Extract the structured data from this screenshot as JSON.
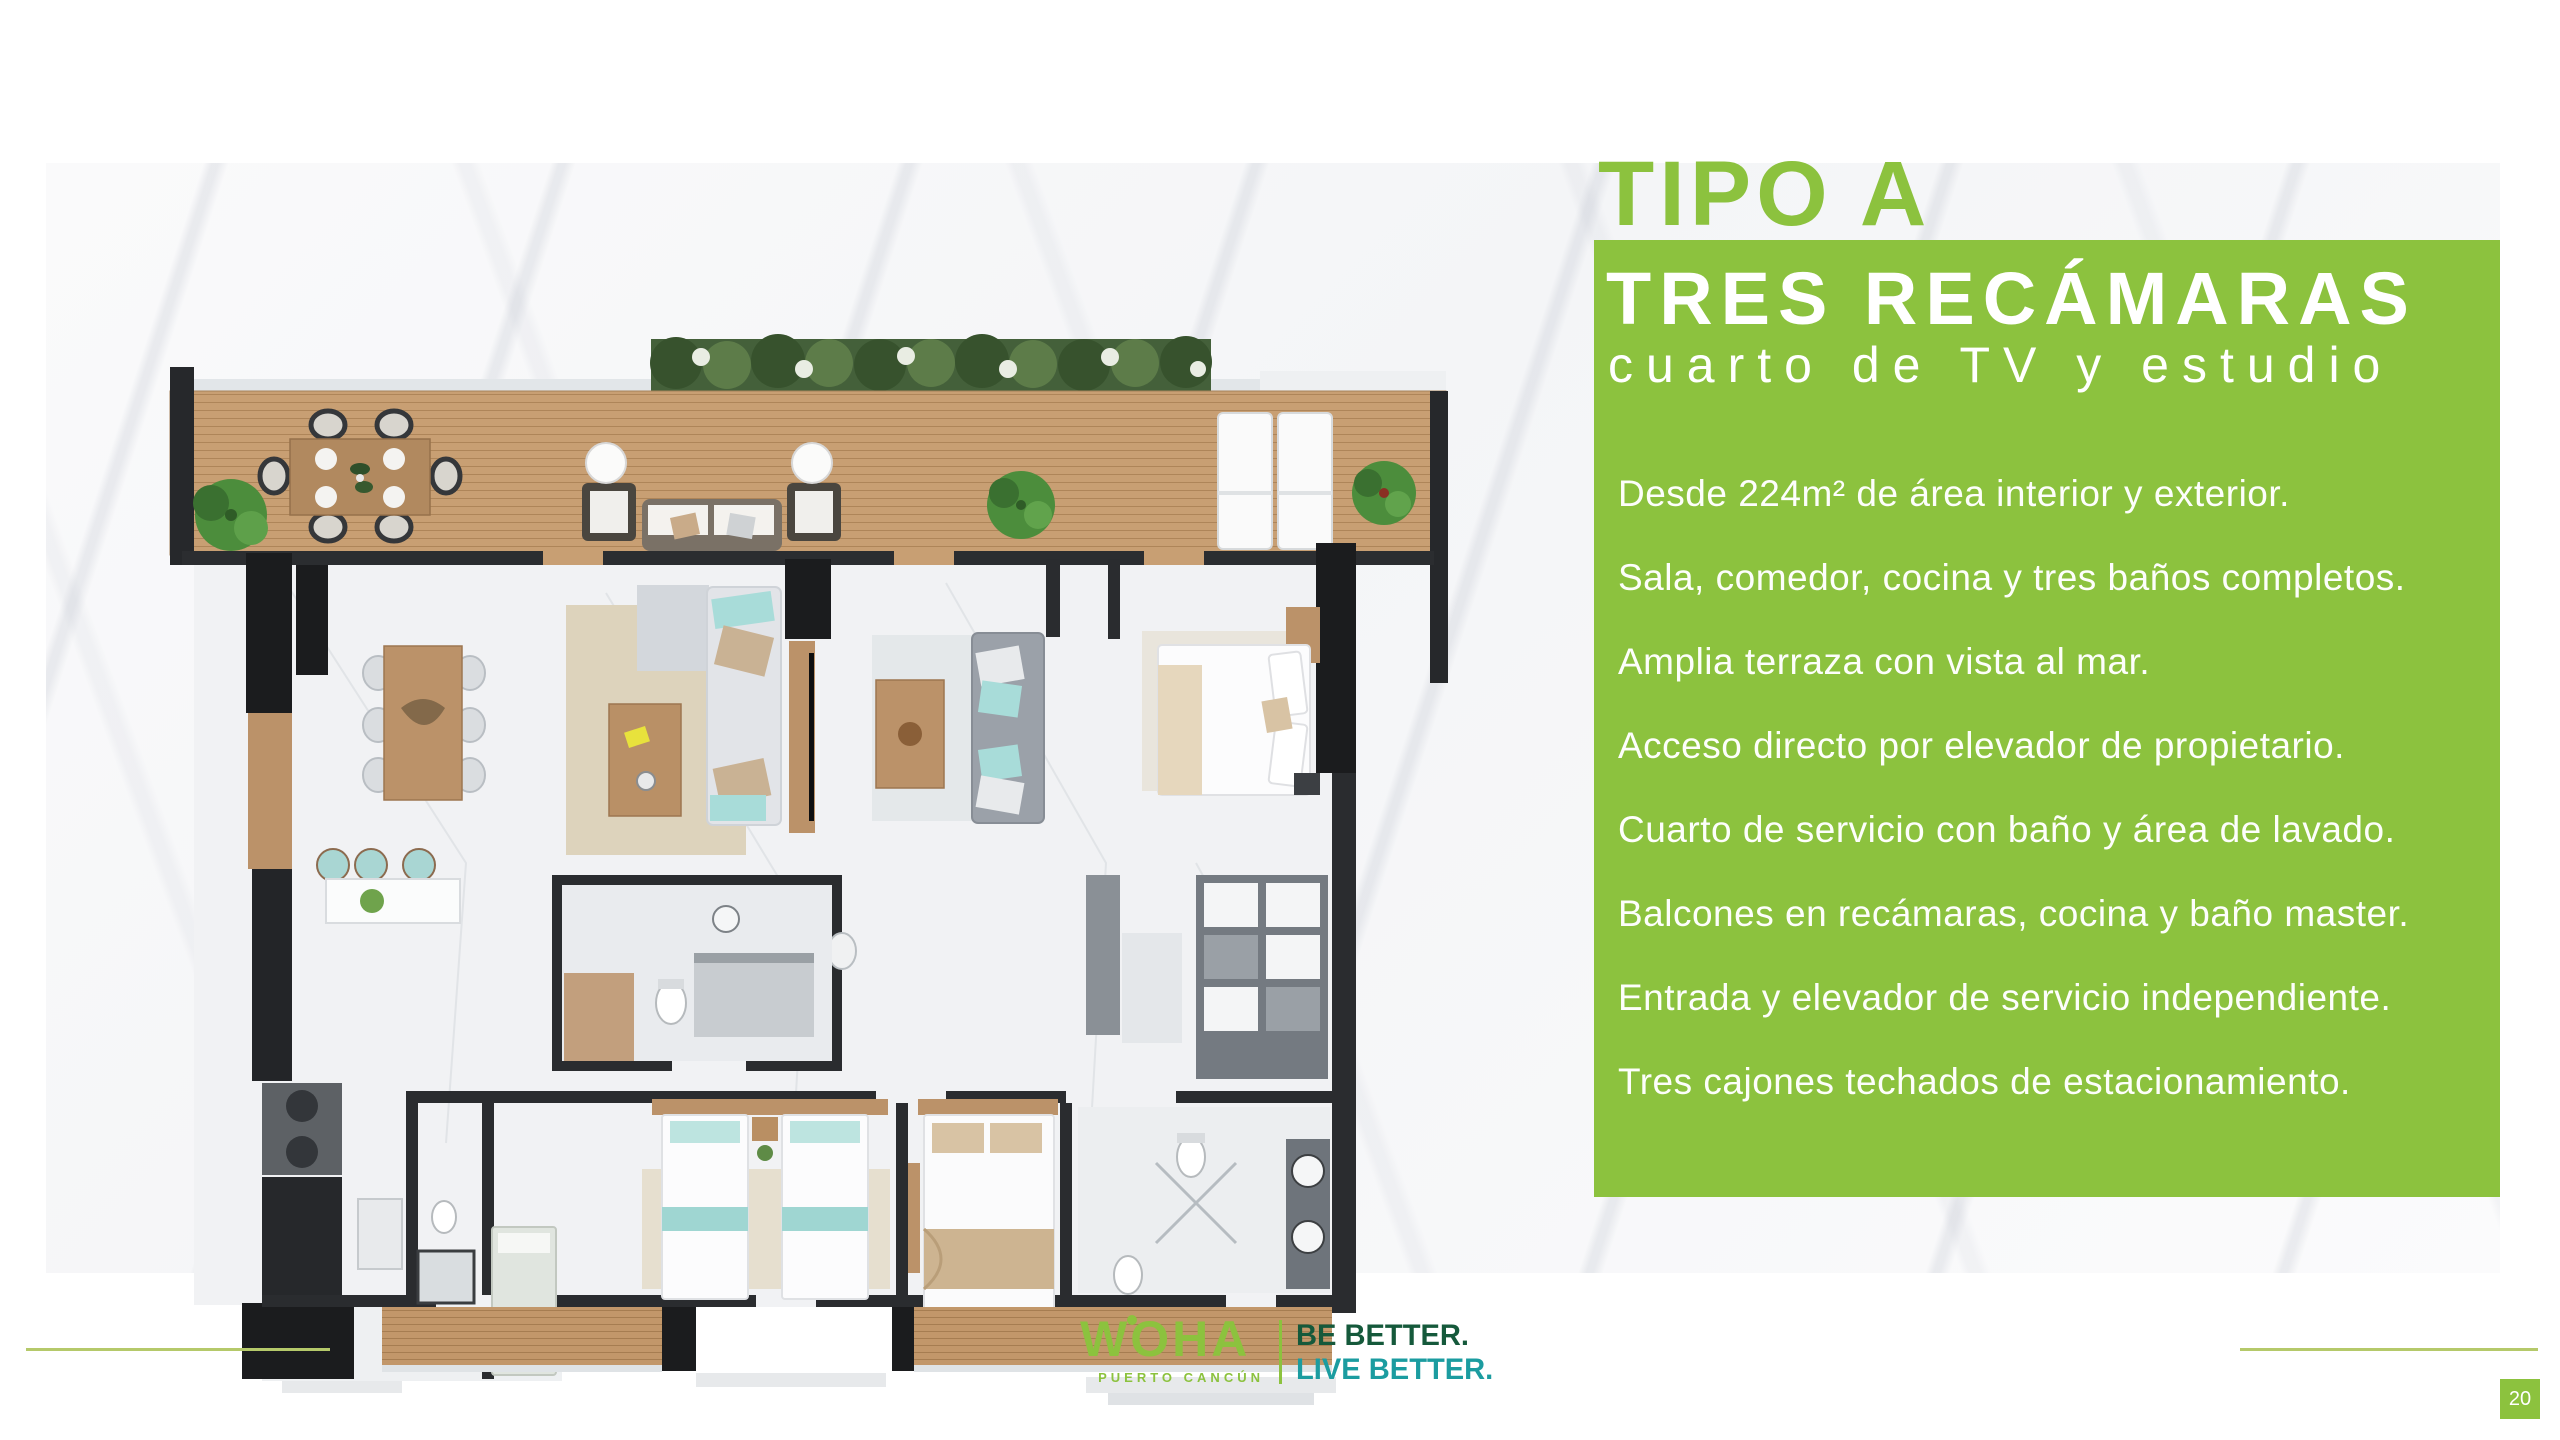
{
  "panel": {
    "eyebrow": "TIPO A",
    "title": "TRES RECÁMARAS",
    "subtitle": "cuarto de TV y estudio",
    "features": [
      "Desde 224m² de área interior y exterior.",
      "Sala, comedor, cocina y tres baños completos.",
      "Amplia terraza con vista al mar.",
      "Acceso directo por elevador de propietario.",
      "Cuarto de servicio con baño y área de lavado.",
      "Balcones en recámaras, cocina y baño master.",
      "Entrada y elevador de servicio independiente.",
      "Tres cajones techados de estacionamiento."
    ]
  },
  "footer": {
    "brand": "WOHA",
    "brand_location": "PUERTO CANCÚN",
    "tagline_line1": "BE BETTER.",
    "tagline_line2": "LIVE BETTER.",
    "page_number": "20"
  },
  "colors": {
    "accent_green": "#8CC23E",
    "tagline_green": "#15593B",
    "tagline_teal": "#1B9CA0",
    "footer_rule": "#B5C96A"
  }
}
